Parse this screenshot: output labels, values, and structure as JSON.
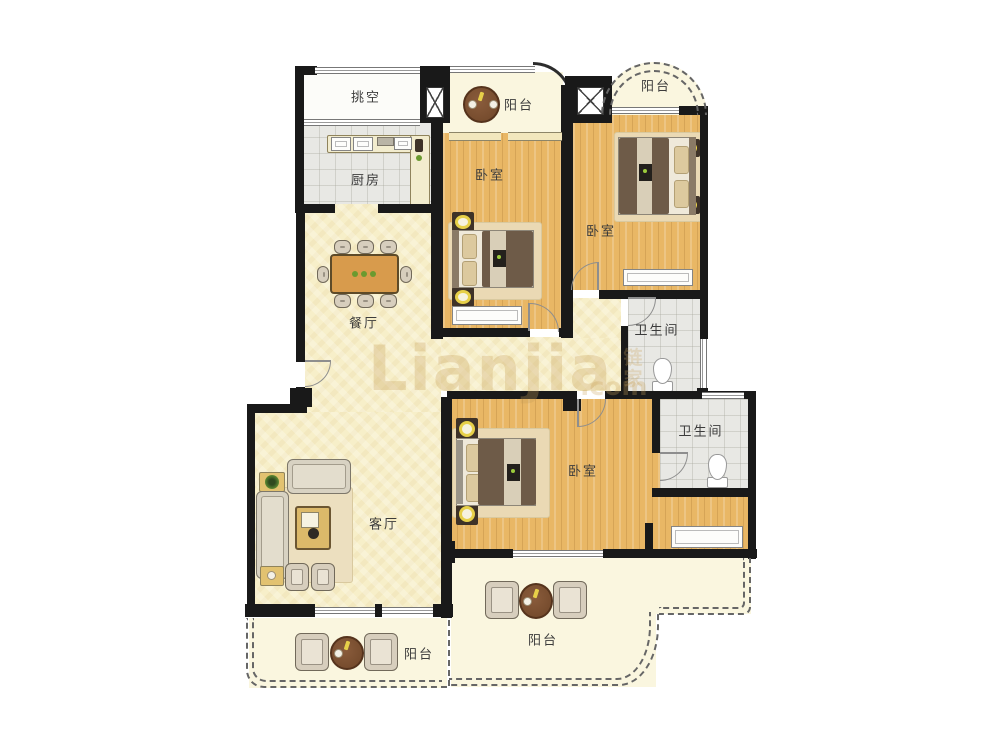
{
  "watermark": {
    "brand": "Lianjia",
    "domain": ".com",
    "seal": "链家"
  },
  "rooms": {
    "void": {
      "label": "挑空"
    },
    "kitchen": {
      "label": "厨房"
    },
    "dining": {
      "label": "餐厅"
    },
    "living": {
      "label": "客厅"
    },
    "bedroom_top": {
      "label": "卧室"
    },
    "bedroom_right": {
      "label": "卧室"
    },
    "bedroom_master": {
      "label": "卧室"
    },
    "bath_upper": {
      "label": "卫生间"
    },
    "bath_lower": {
      "label": "卫生间"
    },
    "balcony_top": {
      "label": "阳台"
    },
    "balcony_top_right": {
      "label": "阳台"
    },
    "balcony_bottom_left": {
      "label": "阳台"
    },
    "balcony_bottom_right": {
      "label": "阳台"
    }
  },
  "colors": {
    "wall": "#191919",
    "wood_floor": "#e9b765",
    "cream_floor": "#f7efc9",
    "tile_floor": "#e8e8e4",
    "balcony_floor": "#faf6df",
    "label_text": "#3c3c3c",
    "watermark": "#c8a058",
    "lamp_accent": "#e7d049",
    "plant_accent": "#6a9a2f",
    "table_wood": "#7a4e30"
  }
}
